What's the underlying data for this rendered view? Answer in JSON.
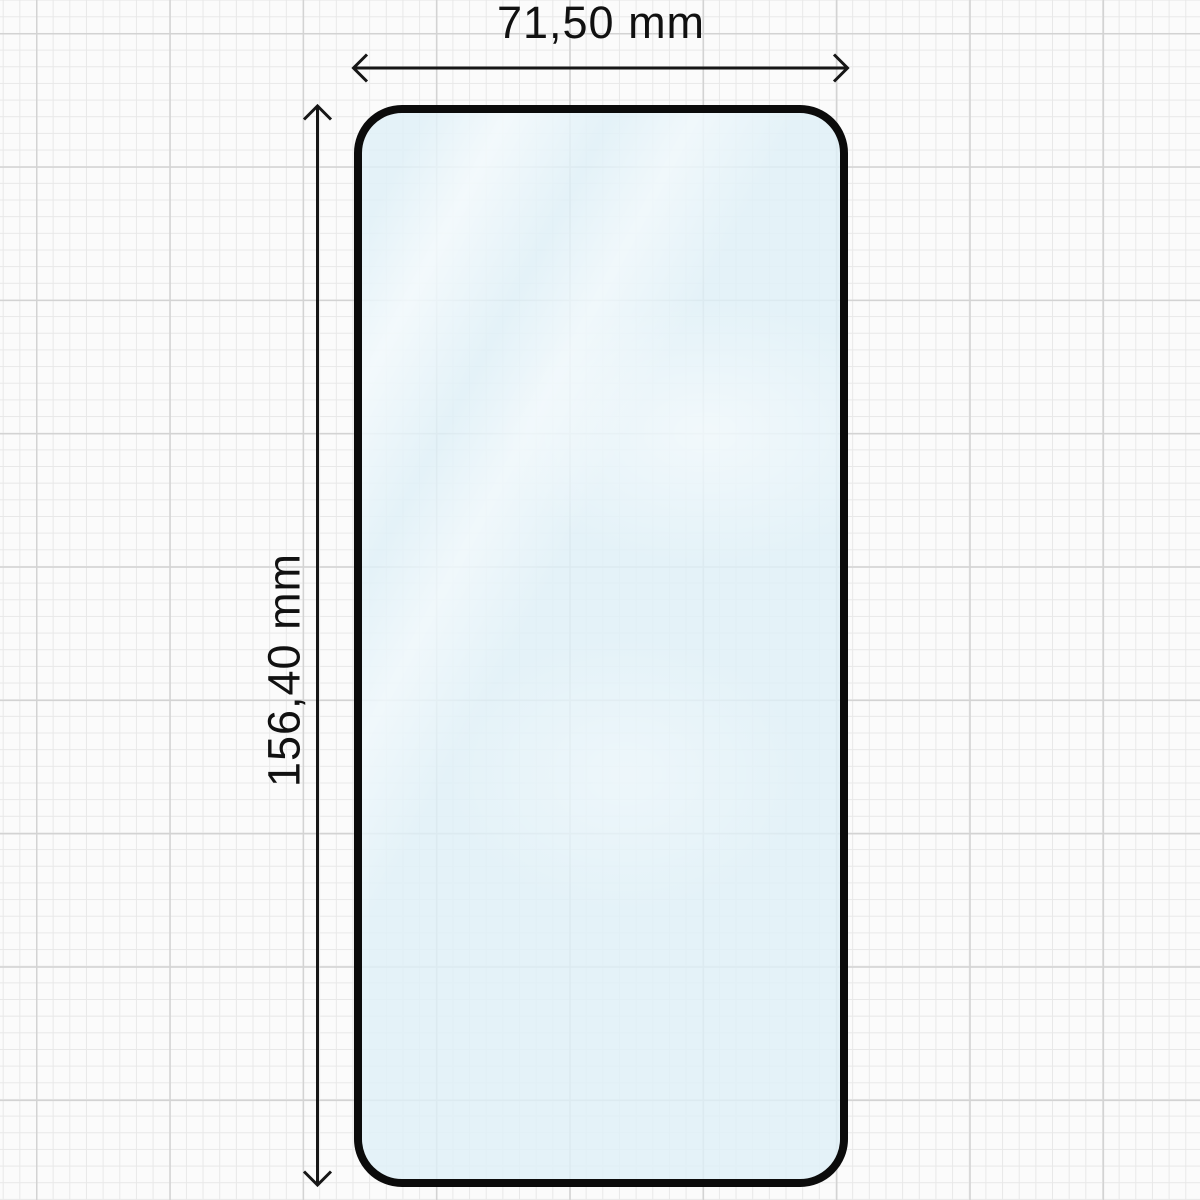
{
  "diagram": {
    "type": "screen-protector-dimension-drawing",
    "width_label": "71,50 mm",
    "height_label": "156,40 mm"
  },
  "colors": {
    "outline": "#0b0b0b",
    "glass_tint": "rgba(223,240,247,0.8)",
    "paper": "#fbfbfb",
    "grid_minor": "#e8e8e8",
    "grid_major": "#d3d3d3",
    "dimension_lines": "#161616",
    "text": "#111111"
  }
}
